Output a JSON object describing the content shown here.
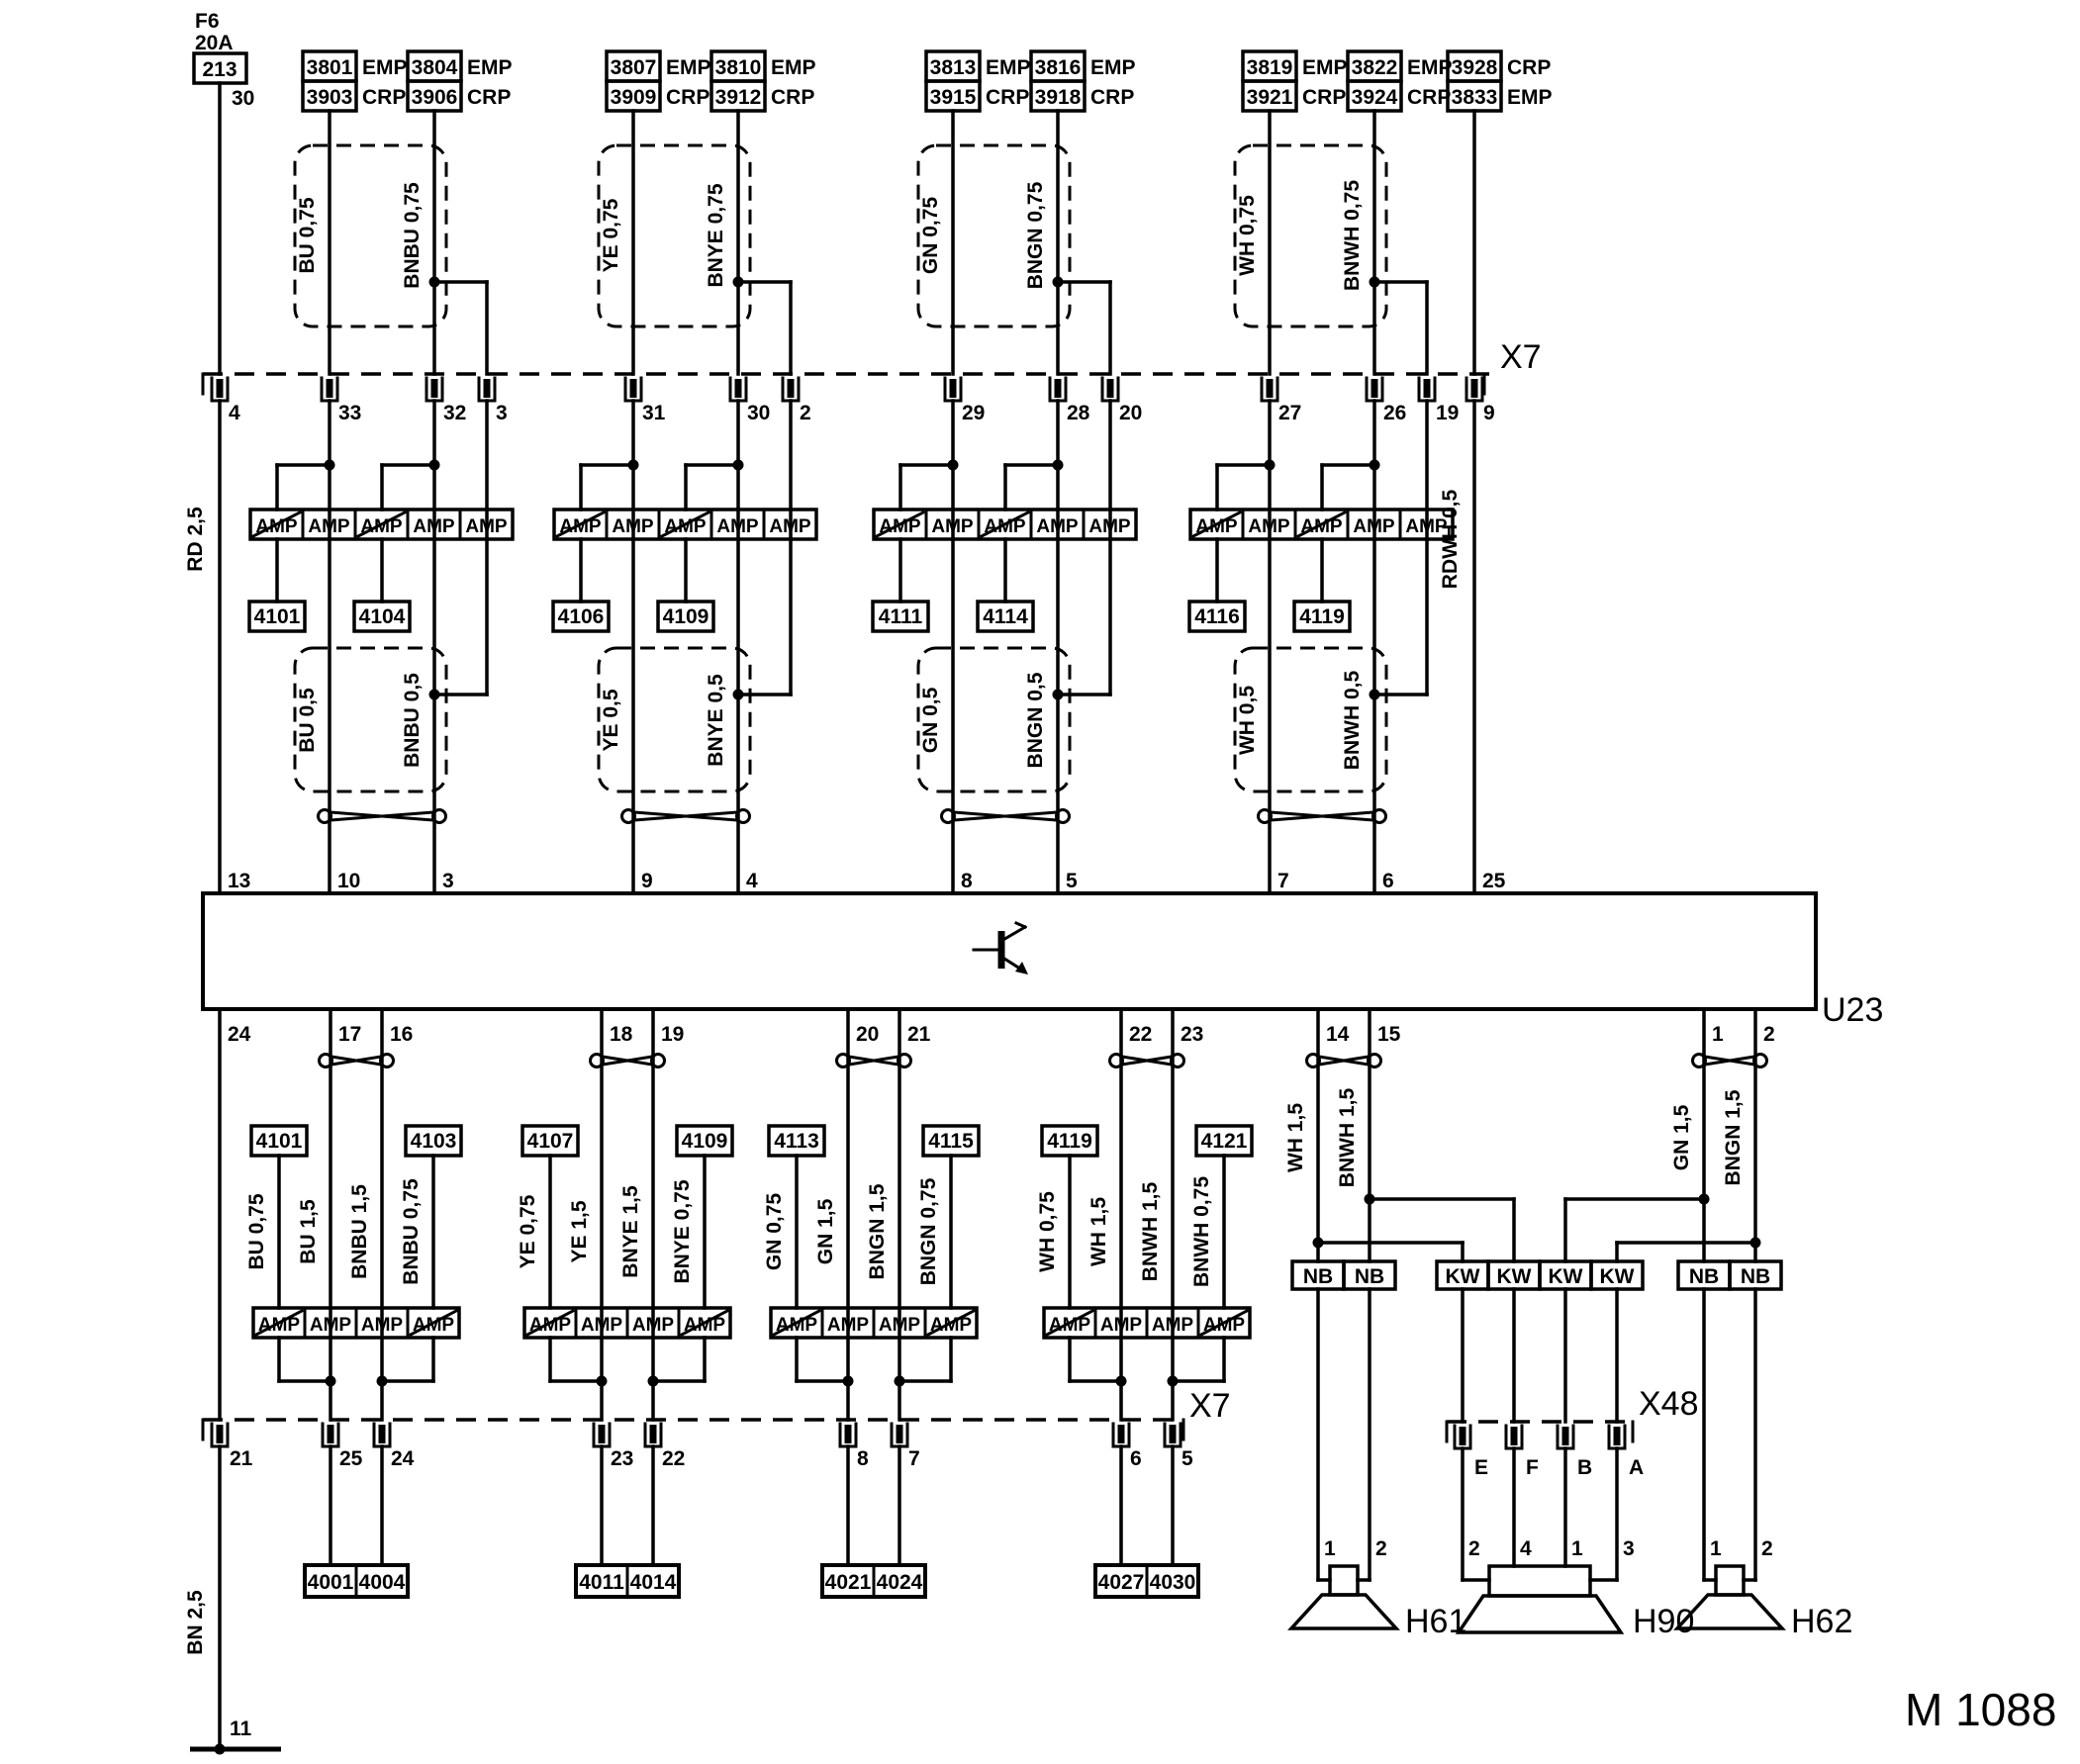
{
  "fuse": {
    "name": "F6",
    "rating": "20A",
    "box": "213",
    "terminal": "30"
  },
  "left_rail": {
    "wire_top": "RD 2,5",
    "wire_bottom": "BN 2,5",
    "x7_pin": "4",
    "u23_top_pin": "13",
    "u23_bottom_pin": "24",
    "x7_bottom_pin": "21",
    "ground_pin": "11"
  },
  "x7_top": {
    "label": "X7"
  },
  "x7_bottom": {
    "label": "X7"
  },
  "u23": {
    "label": "U23"
  },
  "amp_label": "AMP",
  "rdwh": {
    "connector": {
      "rows": [
        {
          "id": "3928",
          "tag": "CRP"
        },
        {
          "id": "3833",
          "tag": "EMP"
        }
      ]
    },
    "wire": "RDWH 0,5",
    "x7_pin": "9",
    "u23_pin": "25"
  },
  "top_groups": [
    {
      "connA": {
        "rows": [
          {
            "id": "3801",
            "tag": "EMP"
          },
          {
            "id": "3903",
            "tag": "CRP"
          }
        ]
      },
      "connB": {
        "rows": [
          {
            "id": "3804",
            "tag": "EMP"
          },
          {
            "id": "3906",
            "tag": "CRP"
          }
        ]
      },
      "wireA": "BU 0,75",
      "wireB": "BNBU 0,75",
      "x7_pins": [
        "33",
        "32",
        "3"
      ],
      "taps": [
        "4101",
        "4104"
      ],
      "wireA2": "BU 0,5",
      "wireB2": "BNBU 0,5",
      "u23_pins": [
        "10",
        "3"
      ]
    },
    {
      "connA": {
        "rows": [
          {
            "id": "3807",
            "tag": "EMP"
          },
          {
            "id": "3909",
            "tag": "CRP"
          }
        ]
      },
      "connB": {
        "rows": [
          {
            "id": "3810",
            "tag": "EMP"
          },
          {
            "id": "3912",
            "tag": "CRP"
          }
        ]
      },
      "wireA": "YE 0,75",
      "wireB": "BNYE 0,75",
      "x7_pins": [
        "31",
        "30",
        "2"
      ],
      "taps": [
        "4106",
        "4109"
      ],
      "wireA2": "YE 0,5",
      "wireB2": "BNYE 0,5",
      "u23_pins": [
        "9",
        "4"
      ]
    },
    {
      "connA": {
        "rows": [
          {
            "id": "3813",
            "tag": "EMP"
          },
          {
            "id": "3915",
            "tag": "CRP"
          }
        ]
      },
      "connB": {
        "rows": [
          {
            "id": "3816",
            "tag": "EMP"
          },
          {
            "id": "3918",
            "tag": "CRP"
          }
        ]
      },
      "wireA": "GN 0,75",
      "wireB": "BNGN 0,75",
      "x7_pins": [
        "29",
        "28",
        "20"
      ],
      "taps": [
        "4111",
        "4114"
      ],
      "wireA2": "GN 0,5",
      "wireB2": "BNGN 0,5",
      "u23_pins": [
        "8",
        "5"
      ]
    },
    {
      "connA": {
        "rows": [
          {
            "id": "3819",
            "tag": "EMP"
          },
          {
            "id": "3921",
            "tag": "CRP"
          }
        ]
      },
      "connB": {
        "rows": [
          {
            "id": "3822",
            "tag": "EMP"
          },
          {
            "id": "3924",
            "tag": "CRP"
          }
        ]
      },
      "wireA": "WH 0,75",
      "wireB": "BNWH 0,75",
      "x7_pins": [
        "27",
        "26",
        "19"
      ],
      "taps": [
        "4116",
        "4119"
      ],
      "wireA2": "WH 0,5",
      "wireB2": "BNWH 0,5",
      "u23_pins": [
        "7",
        "6"
      ]
    }
  ],
  "bottom_groups": [
    {
      "u23_pins": [
        "17",
        "16"
      ],
      "taps": [
        "4101",
        "4103"
      ],
      "wires": [
        "BU 0,75",
        "BU 1,5",
        "BNBU 1,5",
        "BNBU 0,75"
      ],
      "x7_pins": [
        "25",
        "24"
      ],
      "connector": [
        "4001",
        "4004"
      ]
    },
    {
      "u23_pins": [
        "18",
        "19"
      ],
      "taps": [
        "4107",
        "4109"
      ],
      "wires": [
        "YE 0,75",
        "YE 1,5",
        "BNYE 1,5",
        "BNYE 0,75"
      ],
      "x7_pins": [
        "23",
        "22"
      ],
      "connector": [
        "4011",
        "4014"
      ]
    },
    {
      "u23_pins": [
        "20",
        "21"
      ],
      "taps": [
        "4113",
        "4115"
      ],
      "wires": [
        "GN 0,75",
        "GN 1,5",
        "BNGN 1,5",
        "BNGN 0,75"
      ],
      "x7_pins": [
        "8",
        "7"
      ],
      "connector": [
        "4021",
        "4024"
      ]
    },
    {
      "u23_pins": [
        "22",
        "23"
      ],
      "taps": [
        "4119",
        "4121"
      ],
      "wires": [
        "WH 0,75",
        "WH 1,5",
        "BNWH 1,5",
        "BNWH 0,75"
      ],
      "x7_pins": [
        "6",
        "5"
      ],
      "connector": [
        "4027",
        "4030"
      ]
    }
  ],
  "right": {
    "u23_pins": [
      "14",
      "15",
      "1",
      "2"
    ],
    "wires": [
      "WH 1,5",
      "BNWH 1,5",
      "GN 1,5",
      "BNGN 1,5"
    ],
    "sleeves": [
      "NB",
      "NB",
      "KW",
      "KW",
      "KW",
      "KW",
      "NB",
      "NB"
    ],
    "x48": {
      "label": "X48",
      "pins": [
        "E",
        "F",
        "B",
        "A"
      ]
    },
    "speakers": [
      {
        "id": "H61",
        "pins": [
          "1",
          "2"
        ]
      },
      {
        "id": "H90",
        "pins": [
          "2",
          "4",
          "1",
          "3"
        ]
      },
      {
        "id": "H62",
        "pins": [
          "1",
          "2"
        ]
      }
    ]
  },
  "footer": "M 1088",
  "colors": {
    "line": "#000000",
    "background": "#ffffff"
  }
}
